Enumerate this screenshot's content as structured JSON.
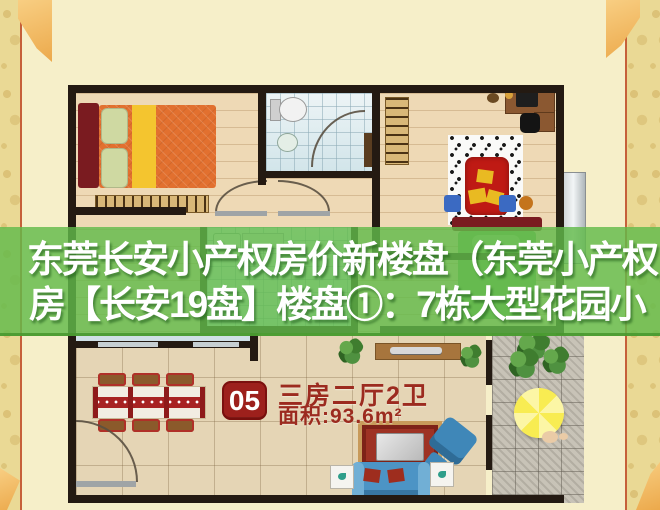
{
  "overlay": {
    "line1": "东莞长安小产权房价新楼盘（东莞小产权",
    "line2": "房【长安19盘】楼盘①：7栋大型花园小",
    "band_color": "#61BB4A"
  },
  "unit_badge": {
    "number": "05",
    "layout": "三房二厅2卫",
    "area": "面积:93.6m²"
  },
  "colors": {
    "page_bg": "#F6EFC9",
    "frame_strip": "#EAD995",
    "frame_line": "#C6603A",
    "corner_tab": "#F2B95F",
    "wall": "#241A12",
    "band": "rgba(97,187,74,0.82)",
    "badge_bg": "#9D201C",
    "label_text": "#9C2B1F",
    "headline_text": "#FFFFFF"
  }
}
